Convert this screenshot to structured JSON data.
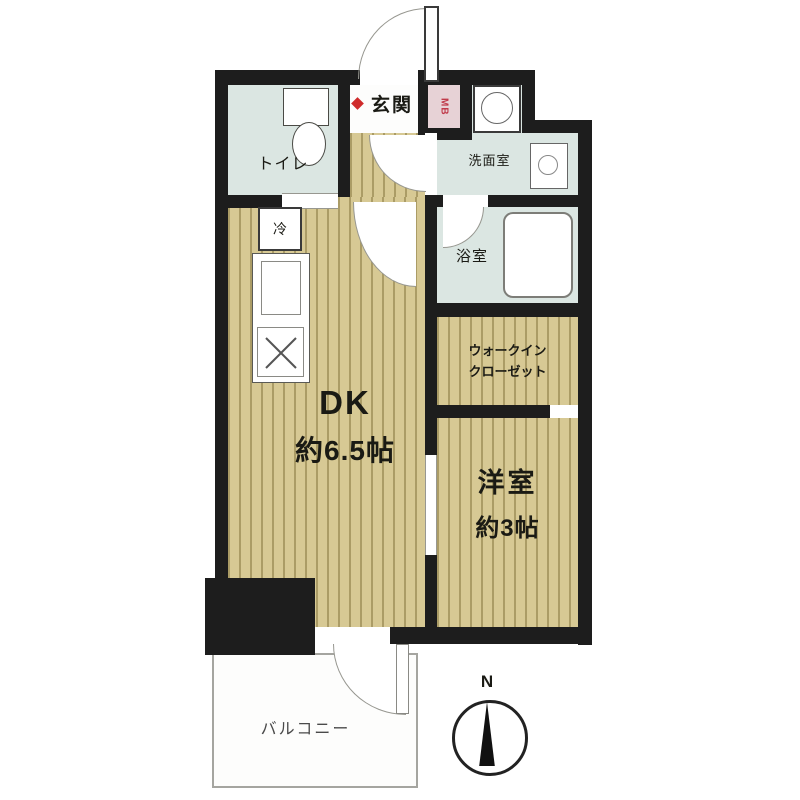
{
  "plan": {
    "toilet_label": "トイレ",
    "entrance_label": "玄関",
    "meter_box_label": "MB",
    "washroom_label": "洗面室",
    "bathroom_label": "浴室",
    "dk_label": "DK",
    "dk_size": "約6.5帖",
    "wic_label_line1": "ウォークイン",
    "wic_label_line2": "クローゼット",
    "western_room_label": "洋室",
    "western_room_size": "約3帖",
    "balcony_label": "バルコニー",
    "fridge_label": "冷",
    "compass_north_label": "N"
  },
  "colors": {
    "wall": "#1d1d1d",
    "wood_floor": "#d7c994",
    "wet_floor": "#dbe6e2",
    "meter_box_bg": "#e7d2d6",
    "meter_box_text": "#c03a4a",
    "entrance_marker": "#cf2b2b"
  }
}
